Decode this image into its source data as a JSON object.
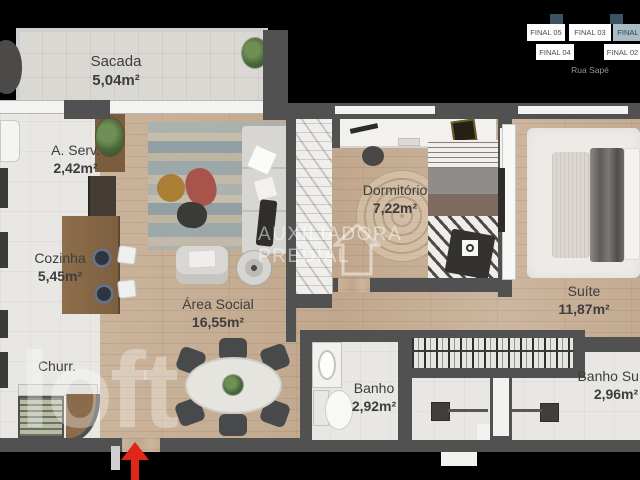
{
  "plan": {
    "rooms": {
      "sacada": {
        "name": "Sacada",
        "area": "5,04m²"
      },
      "aserv": {
        "name": "A. Serv.",
        "area": "2,42m²"
      },
      "cozinha": {
        "name": "Cozinha",
        "area": "5,45m²"
      },
      "churr": {
        "name": "Churr.",
        "area": ""
      },
      "area_social": {
        "name": "Área Social",
        "area": "16,55m²"
      },
      "dormitorio": {
        "name": "Dormitório",
        "area": "7,22m²"
      },
      "suite": {
        "name": "Suíte",
        "area": "11,87m²"
      },
      "banho": {
        "name": "Banho",
        "area": "2,92m²"
      },
      "banho_suite": {
        "name": "Banho Suíte",
        "area": "2,96m²"
      }
    }
  },
  "locator": {
    "street": "Rua Sapé",
    "units": {
      "f05": {
        "label": "FINAL 05",
        "highlighted": false
      },
      "f03": {
        "label": "FINAL 03",
        "highlighted": false
      },
      "f01": {
        "label": "FINAL 01",
        "highlighted": true
      },
      "f04": {
        "label": "FINAL 04",
        "highlighted": false
      },
      "f02": {
        "label": "FINAL 02",
        "highlighted": false
      }
    }
  },
  "watermarks": {
    "brand_line1": "AUXILIADORA",
    "brand_line2": "PREDIAL",
    "logo": "loft"
  },
  "colors": {
    "entrance_arrow": "#e0251a",
    "locator_highlight": "#a9bdc7",
    "wall": "#515151",
    "wood_floor": "#c9b29a"
  }
}
